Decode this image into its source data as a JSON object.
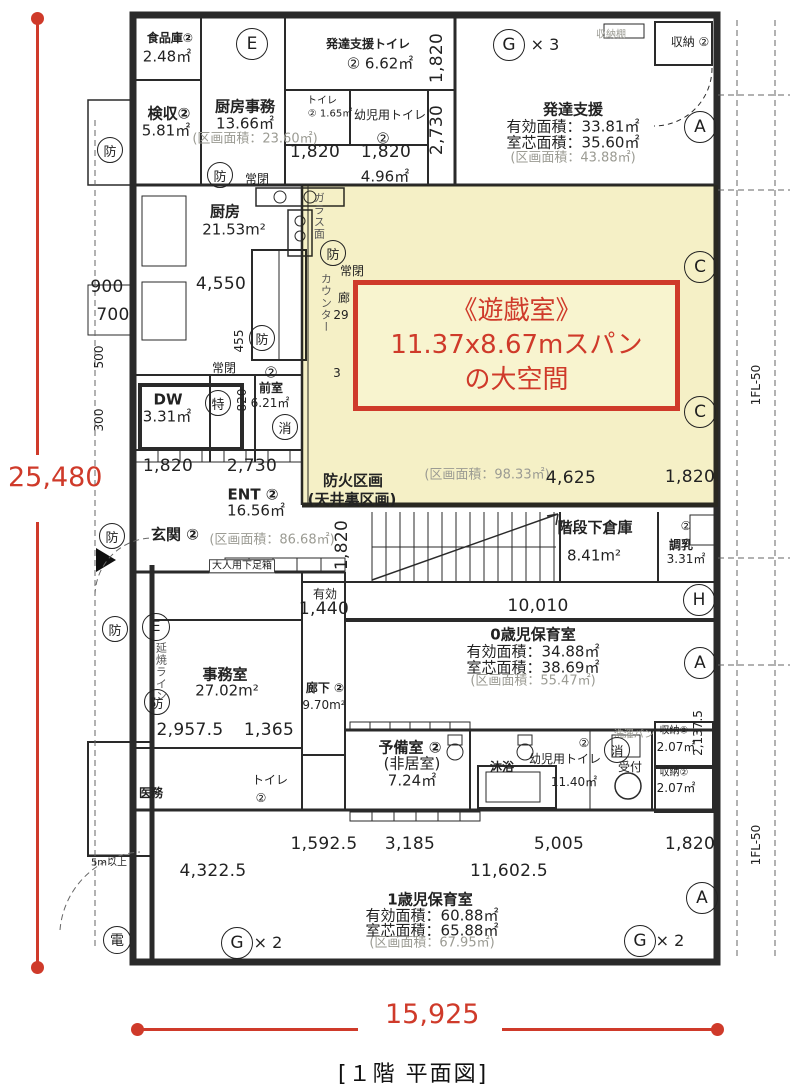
{
  "colors": {
    "accent": "#cf3a2a",
    "highlight": "rgba(243,236,184,0.8)",
    "wall": "#2a2a2a",
    "gray": "#9b9b93"
  },
  "overall": {
    "height_label": "25,480",
    "width_label": "15,925"
  },
  "caption": "[１階 平面図]",
  "callout": {
    "line1": "《遊戯室》",
    "line2": "11.37x8.67mスパン",
    "line3": "の大空間"
  },
  "labels": [
    {
      "x": 170,
      "y": 39,
      "t": "食品庫②",
      "c": "rm sm"
    },
    {
      "x": 167,
      "y": 57,
      "t": "2.48㎡",
      "c": "ar"
    },
    {
      "x": 169,
      "y": 114,
      "t": "検収②",
      "c": "rm"
    },
    {
      "x": 166,
      "y": 131,
      "t": "5.81㎡",
      "c": "ar"
    },
    {
      "x": 245,
      "y": 107,
      "t": "厨房事務",
      "c": "rm"
    },
    {
      "x": 245,
      "y": 124,
      "t": "13.66㎡",
      "c": "ar"
    },
    {
      "x": 255,
      "y": 140,
      "t": "(区画面積：23.60㎡)",
      "c": "gray"
    },
    {
      "x": 368,
      "y": 45,
      "t": "発達支援トイレ",
      "c": "rm sm"
    },
    {
      "x": 380,
      "y": 64,
      "t": "② 6.62㎡",
      "c": "ar"
    },
    {
      "x": 322,
      "y": 101,
      "t": "トイレ",
      "c": "xs"
    },
    {
      "x": 330,
      "y": 114,
      "t": "② 1.65㎡",
      "c": "xs"
    },
    {
      "x": 390,
      "y": 116,
      "t": "幼児用トイレ",
      "c": "sm"
    },
    {
      "x": 383,
      "y": 139,
      "t": "②",
      "c": "ar"
    },
    {
      "x": 385,
      "y": 177,
      "t": "4.96㎡",
      "c": "ar"
    },
    {
      "x": 611,
      "y": 35,
      "t": "収納棚",
      "c": "xs gray"
    },
    {
      "x": 690,
      "y": 43,
      "t": "収納 ②",
      "c": "sm"
    },
    {
      "x": 573,
      "y": 110,
      "t": "発達支援",
      "c": "rm"
    },
    {
      "x": 573,
      "y": 127,
      "t": "有効面積：33.81㎡",
      "c": "ar"
    },
    {
      "x": 573,
      "y": 143,
      "t": "室芯面積：35.60㎡",
      "c": "ar"
    },
    {
      "x": 573,
      "y": 159,
      "t": "(区画面積：43.88㎡)",
      "c": "gray"
    },
    {
      "x": 225,
      "y": 212,
      "t": "厨房",
      "c": "rm"
    },
    {
      "x": 234,
      "y": 230,
      "t": "21.53m²",
      "c": "ar"
    },
    {
      "x": 257,
      "y": 180,
      "t": "常閉",
      "c": "sm"
    },
    {
      "x": 352,
      "y": 272,
      "t": "常閉",
      "c": "sm"
    },
    {
      "x": 224,
      "y": 369,
      "t": "常閉",
      "c": "sm"
    },
    {
      "x": 318,
      "y": 216,
      "t": "ガラス面",
      "c": "vjp"
    },
    {
      "x": 325,
      "y": 303,
      "t": "カウンター",
      "c": "vjp"
    },
    {
      "x": 344,
      "y": 299,
      "t": "廊",
      "c": "sm"
    },
    {
      "x": 341,
      "y": 316,
      "t": "29",
      "c": "sm"
    },
    {
      "x": 337,
      "y": 374,
      "t": "3",
      "c": "sm"
    },
    {
      "x": 168,
      "y": 400,
      "t": "DW",
      "c": "rm"
    },
    {
      "x": 167,
      "y": 417,
      "t": "3.31㎡",
      "c": "ar"
    },
    {
      "x": 271,
      "y": 373,
      "t": "②",
      "c": "ar"
    },
    {
      "x": 271,
      "y": 389,
      "t": "前室",
      "c": "rm sm"
    },
    {
      "x": 270,
      "y": 404,
      "t": "6.21㎡",
      "c": "sm"
    },
    {
      "x": 353,
      "y": 481,
      "t": "防火区画",
      "c": "rm"
    },
    {
      "x": 352,
      "y": 500,
      "t": "(天井裏区画)",
      "c": "rm"
    },
    {
      "x": 487,
      "y": 476,
      "t": "(区画面積：98.33㎡)",
      "c": "gray"
    },
    {
      "x": 253,
      "y": 495,
      "t": "ENT ②",
      "c": "rm"
    },
    {
      "x": 256,
      "y": 511,
      "t": "16.56㎡",
      "c": "ar"
    },
    {
      "x": 272,
      "y": 541,
      "t": "(区画面積：86.68㎡)",
      "c": "gray"
    },
    {
      "x": 175,
      "y": 535,
      "t": "玄関 ②",
      "c": "rm"
    },
    {
      "x": 242,
      "y": 566,
      "t": "大人用下足箱",
      "c": "xs boxed"
    },
    {
      "x": 325,
      "y": 595,
      "t": "有効",
      "c": "sm"
    },
    {
      "x": 595,
      "y": 528,
      "t": "階段下倉庫",
      "c": "rm"
    },
    {
      "x": 594,
      "y": 556,
      "t": "8.41m²",
      "c": "ar"
    },
    {
      "x": 686,
      "y": 527,
      "t": "②",
      "c": "sm"
    },
    {
      "x": 681,
      "y": 546,
      "t": "調乳",
      "c": "sm rm"
    },
    {
      "x": 686,
      "y": 560,
      "t": "3.31㎡",
      "c": "sm"
    },
    {
      "x": 533,
      "y": 635,
      "t": "0歳児保育室",
      "c": "rm"
    },
    {
      "x": 533,
      "y": 652,
      "t": "有効面積：34.88㎡",
      "c": "ar"
    },
    {
      "x": 533,
      "y": 668,
      "t": "室芯面積：38.69㎡",
      "c": "ar"
    },
    {
      "x": 533,
      "y": 682,
      "t": "(区画面積：55.47㎡)",
      "c": "gray"
    },
    {
      "x": 225,
      "y": 675,
      "t": "事務室",
      "c": "rm"
    },
    {
      "x": 227,
      "y": 691,
      "t": "27.02m²",
      "c": "ar"
    },
    {
      "x": 325,
      "y": 689,
      "t": "廊下 ②",
      "c": "rm sm"
    },
    {
      "x": 324,
      "y": 706,
      "t": "9.70m²",
      "c": "sm"
    },
    {
      "x": 160,
      "y": 672,
      "t": "延焼ライン",
      "c": "vjp"
    },
    {
      "x": 151,
      "y": 794,
      "t": "医務",
      "c": "sm rm"
    },
    {
      "x": 270,
      "y": 781,
      "t": "トイレ",
      "c": "sm"
    },
    {
      "x": 261,
      "y": 799,
      "t": "②",
      "c": "sm"
    },
    {
      "x": 410,
      "y": 748,
      "t": "予備室 ②",
      "c": "rm"
    },
    {
      "x": 412,
      "y": 764,
      "t": "(非居室)",
      "c": "ar"
    },
    {
      "x": 412,
      "y": 781,
      "t": "7.24㎡",
      "c": "ar"
    },
    {
      "x": 502,
      "y": 768,
      "t": "沐浴",
      "c": "rm sm"
    },
    {
      "x": 565,
      "y": 760,
      "t": "幼児用トイレ",
      "c": "sm"
    },
    {
      "x": 584,
      "y": 744,
      "t": "②",
      "c": "sm"
    },
    {
      "x": 574,
      "y": 783,
      "t": "11.40㎡",
      "c": "sm"
    },
    {
      "x": 630,
      "y": 768,
      "t": "受付",
      "c": "sm"
    },
    {
      "x": 634,
      "y": 735,
      "t": "洗濯パン",
      "c": "xs gray"
    },
    {
      "x": 674,
      "y": 731,
      "t": "収納②",
      "c": "xs"
    },
    {
      "x": 676,
      "y": 748,
      "t": "2.07㎡",
      "c": "sm"
    },
    {
      "x": 674,
      "y": 773,
      "t": "収納②",
      "c": "xs"
    },
    {
      "x": 676,
      "y": 789,
      "t": "2.07㎡",
      "c": "sm"
    },
    {
      "x": 430,
      "y": 900,
      "t": "1歳児保育室",
      "c": "rm"
    },
    {
      "x": 432,
      "y": 916,
      "t": "有効面積：60.88㎡",
      "c": "ar"
    },
    {
      "x": 432,
      "y": 931,
      "t": "室芯面積：65.88㎡",
      "c": "ar"
    },
    {
      "x": 432,
      "y": 944,
      "t": "(区画面積：67.95㎡)",
      "c": "gray"
    },
    {
      "x": 109,
      "y": 863,
      "t": "5m以上",
      "c": "xs"
    },
    {
      "x": 545,
      "y": 45,
      "t": "× 3",
      "c": "mx"
    },
    {
      "x": 670,
      "y": 941,
      "t": "× 2",
      "c": "mx"
    },
    {
      "x": 268,
      "y": 943,
      "t": "× 2",
      "c": "mx"
    },
    {
      "x": 315,
      "y": 153,
      "t": "1,820",
      "c": "dim"
    },
    {
      "x": 386,
      "y": 153,
      "t": "1,820",
      "c": "dim"
    },
    {
      "x": 168,
      "y": 467,
      "t": "1,820",
      "c": "dim"
    },
    {
      "x": 252,
      "y": 467,
      "t": "2,730",
      "c": "dim"
    },
    {
      "x": 571,
      "y": 479,
      "t": "4,625",
      "c": "dim"
    },
    {
      "x": 690,
      "y": 478,
      "t": "1,820",
      "c": "dim"
    },
    {
      "x": 221,
      "y": 285,
      "t": "4,550",
      "c": "dim"
    },
    {
      "x": 324,
      "y": 610,
      "t": "1,440",
      "c": "dim"
    },
    {
      "x": 538,
      "y": 607,
      "t": "10,010",
      "c": "dim"
    },
    {
      "x": 190,
      "y": 731,
      "t": "2,957.5",
      "c": "dim"
    },
    {
      "x": 269,
      "y": 731,
      "t": "1,365",
      "c": "dim"
    },
    {
      "x": 324,
      "y": 845,
      "t": "1,592.5",
      "c": "dim"
    },
    {
      "x": 410,
      "y": 845,
      "t": "3,185",
      "c": "dim"
    },
    {
      "x": 559,
      "y": 845,
      "t": "5,005",
      "c": "dim"
    },
    {
      "x": 690,
      "y": 845,
      "t": "1,820",
      "c": "dim"
    },
    {
      "x": 509,
      "y": 872,
      "t": "11,602.5",
      "c": "dim"
    },
    {
      "x": 213,
      "y": 872,
      "t": "4,322.5",
      "c": "dim"
    },
    {
      "x": 107,
      "y": 288,
      "t": "900",
      "c": "dim"
    },
    {
      "x": 113,
      "y": 316,
      "t": "700",
      "c": "dim"
    },
    {
      "x": 438,
      "y": 58,
      "t": "1,820",
      "c": "dim rot"
    },
    {
      "x": 438,
      "y": 130,
      "t": "2,730",
      "c": "dim rot"
    },
    {
      "x": 243,
      "y": 400,
      "t": "820",
      "c": "sm rot"
    },
    {
      "x": 240,
      "y": 341,
      "t": "455",
      "c": "sm rot"
    },
    {
      "x": 343,
      "y": 545,
      "t": "1,820",
      "c": "dim rot"
    },
    {
      "x": 699,
      "y": 733,
      "t": "2,137.5",
      "c": "sm rot"
    },
    {
      "x": 100,
      "y": 357,
      "t": "500",
      "c": "sm rot"
    },
    {
      "x": 100,
      "y": 420,
      "t": "300",
      "c": "sm rot"
    },
    {
      "x": 757,
      "y": 385,
      "t": "1FL-50",
      "c": "sm rot"
    },
    {
      "x": 757,
      "y": 845,
      "t": "1FL-50",
      "c": "sm rot"
    }
  ],
  "markers": [
    {
      "x": 252,
      "y": 44,
      "t": "E",
      "d": 30
    },
    {
      "x": 509,
      "y": 45,
      "t": "G",
      "d": 30
    },
    {
      "x": 700,
      "y": 127,
      "t": "A",
      "d": 30
    },
    {
      "x": 700,
      "y": 267,
      "t": "C",
      "d": 30
    },
    {
      "x": 700,
      "y": 412,
      "t": "C",
      "d": 30
    },
    {
      "x": 699,
      "y": 600,
      "t": "H",
      "d": 30
    },
    {
      "x": 700,
      "y": 663,
      "t": "A",
      "d": 30
    },
    {
      "x": 702,
      "y": 898,
      "t": "A",
      "d": 30
    },
    {
      "x": 640,
      "y": 941,
      "t": "G",
      "d": 30
    },
    {
      "x": 237,
      "y": 943,
      "t": "G",
      "d": 30
    },
    {
      "x": 156,
      "y": 627,
      "t": "E",
      "d": 26
    },
    {
      "x": 110,
      "y": 150,
      "t": "防",
      "d": 24
    },
    {
      "x": 220,
      "y": 175,
      "t": "防",
      "d": 24
    },
    {
      "x": 333,
      "y": 253,
      "t": "防",
      "d": 24
    },
    {
      "x": 262,
      "y": 338,
      "t": "防",
      "d": 24
    },
    {
      "x": 112,
      "y": 536,
      "t": "防",
      "d": 24
    },
    {
      "x": 115,
      "y": 629,
      "t": "防",
      "d": 24
    },
    {
      "x": 157,
      "y": 702,
      "t": "防",
      "d": 24
    },
    {
      "x": 218,
      "y": 403,
      "t": "特",
      "d": 24
    },
    {
      "x": 285,
      "y": 427,
      "t": "消",
      "d": 24
    },
    {
      "x": 617,
      "y": 750,
      "t": "消",
      "d": 24
    },
    {
      "x": 117,
      "y": 940,
      "t": "電",
      "d": 26
    }
  ]
}
